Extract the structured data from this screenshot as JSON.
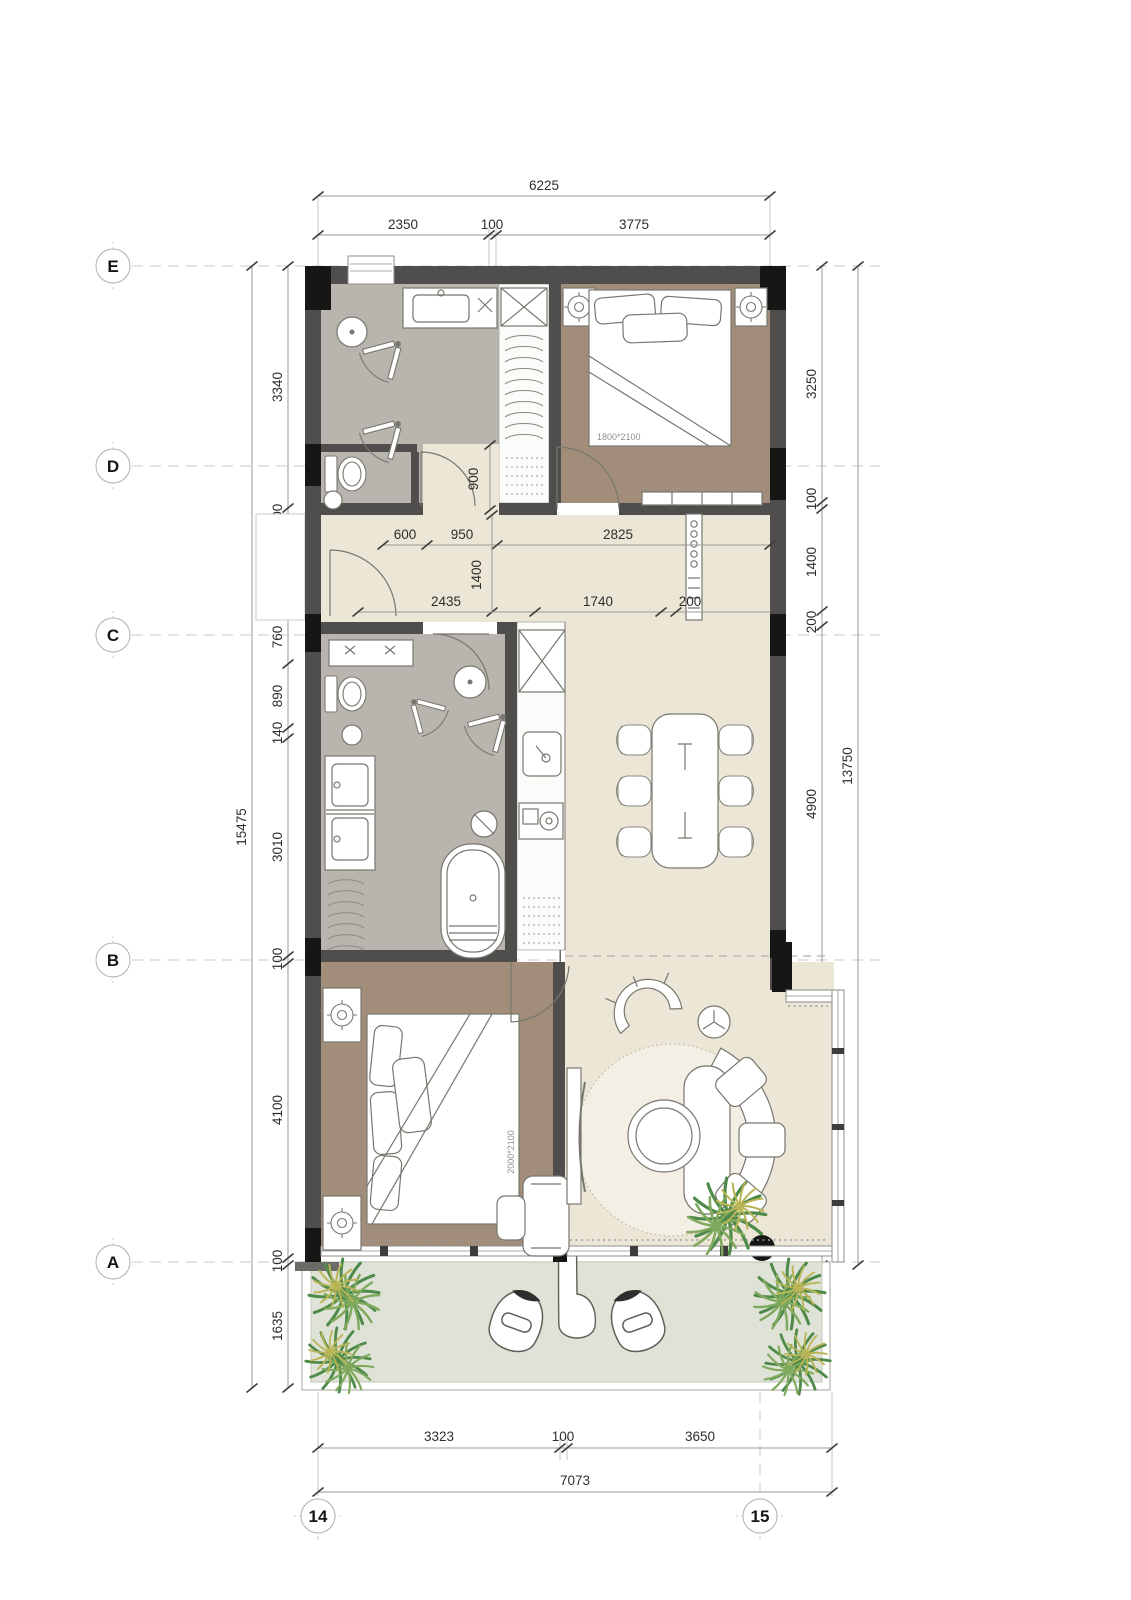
{
  "grid": {
    "rows": [
      {
        "label": "E"
      },
      {
        "label": "D"
      },
      {
        "label": "C"
      },
      {
        "label": "B"
      },
      {
        "label": "A"
      }
    ],
    "cols": [
      {
        "label": "14"
      },
      {
        "label": "15"
      }
    ]
  },
  "dims": {
    "top_total": "6225",
    "top_segments": [
      "2350",
      "100",
      "3775"
    ],
    "left_total": "15475",
    "left_segments": [
      "3340",
      "200",
      "1100",
      "100",
      "760",
      "890",
      "140",
      "3010",
      "100",
      "4100",
      "100",
      "1635"
    ],
    "right_total": "13750",
    "right_segments": [
      "3250",
      "100",
      "1400",
      "200",
      "4900",
      "3900"
    ],
    "bottom_segments": [
      "3323",
      "100",
      "3650"
    ],
    "bottom_total": "7073",
    "interior": {
      "v900": "900",
      "h600": "600",
      "h950": "950",
      "h2825": "2825",
      "v1400": "1400",
      "h2435": "2435",
      "h1740": "1740",
      "h200": "200"
    }
  },
  "labels": {
    "bed_master": "1800*2100",
    "bed_second": "2000*2100"
  },
  "colors": {
    "wall": "#4f4e4c",
    "column": "#161615",
    "floor_bath": "#b9b5ae",
    "floor_bed": "#a18d79",
    "floor_main": "#ece6d6",
    "floor_closet": "#fbfbf9",
    "floor_terrace": "#dfe2d6",
    "rug": "#f4efe4",
    "plant_dark": "#4e8a49",
    "plant_light": "#7fa95c",
    "plant_accent": "#b9b455"
  }
}
